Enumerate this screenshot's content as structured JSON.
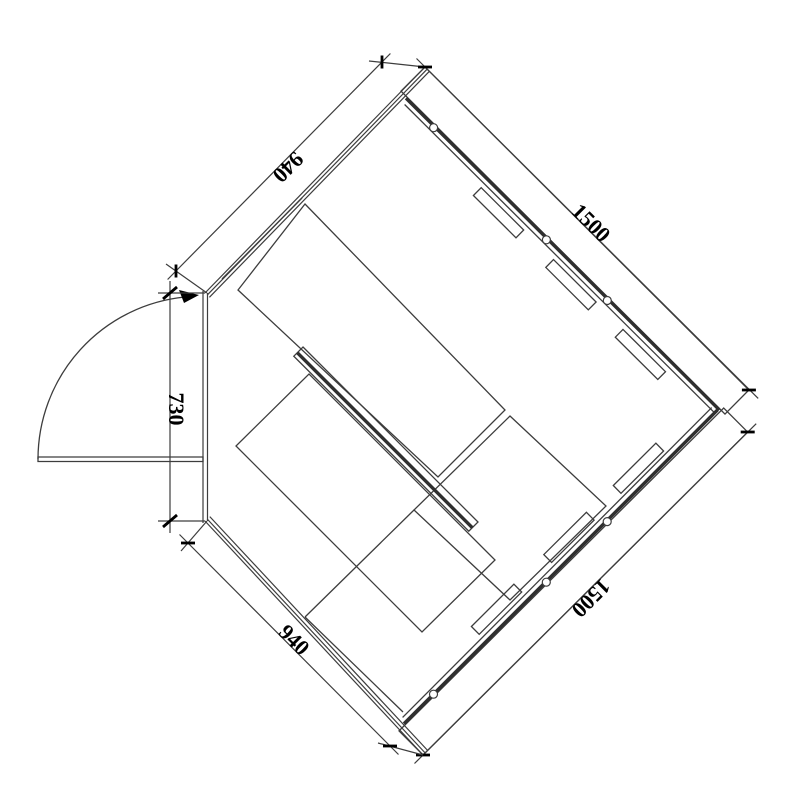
{
  "diagram": {
    "type": "floor-plan",
    "dimension_labels": {
      "wall_top_left": "940",
      "wall_top_right": "1500",
      "door_side": "730",
      "wall_bottom_left": "940",
      "wall_bottom_right": "1500"
    },
    "colors": {
      "line": "#3d3d3d",
      "panel_line": "#2f2f2f",
      "text": "#000000",
      "background": "#ffffff"
    }
  }
}
